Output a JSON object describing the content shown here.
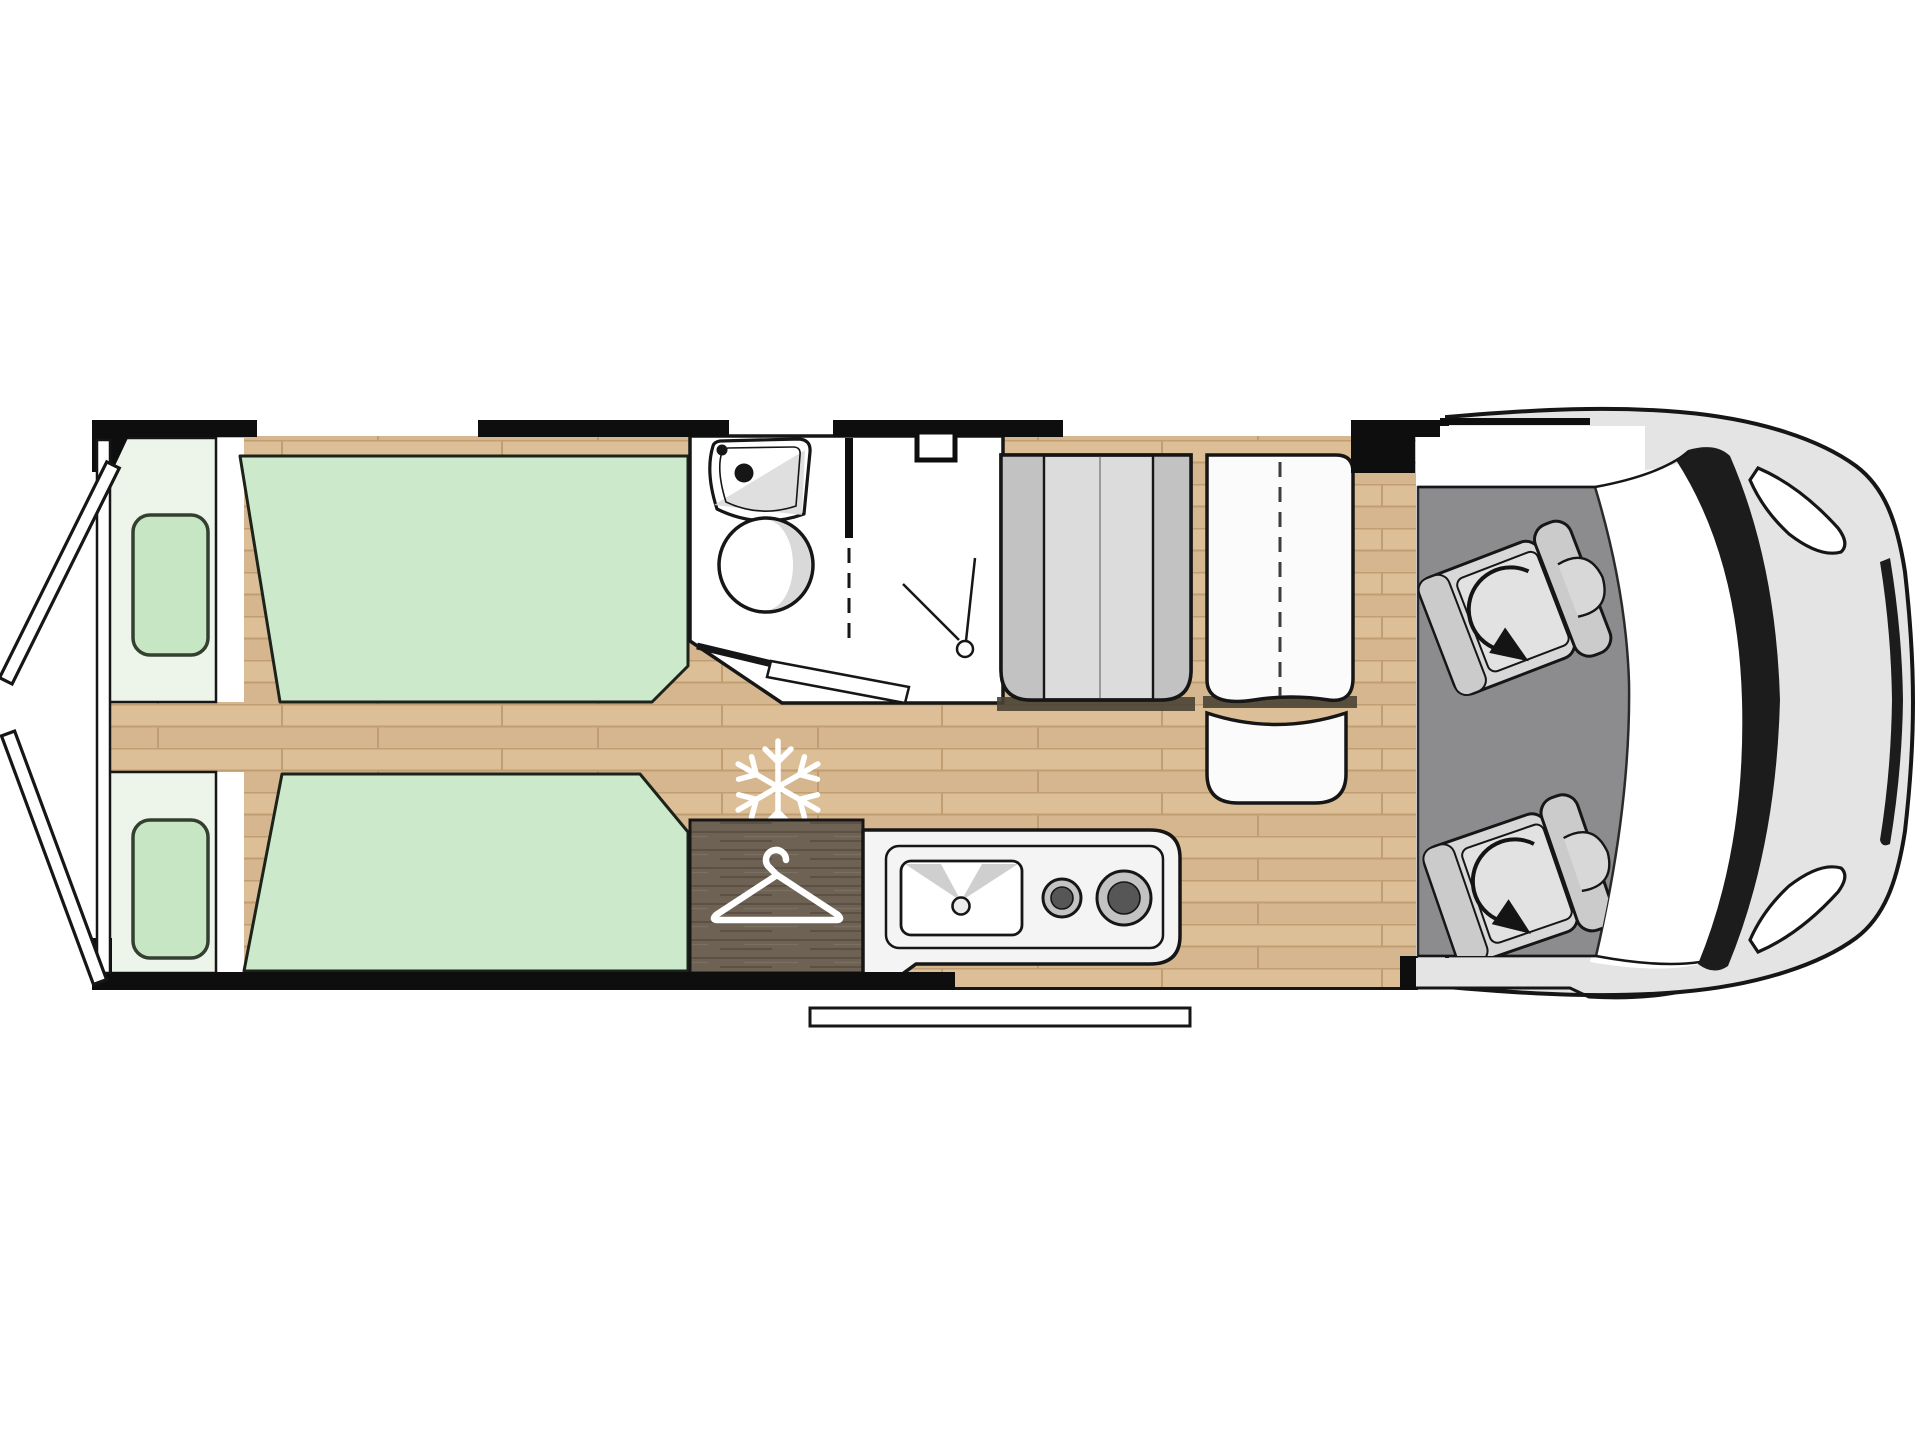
{
  "title": "motorhome-floorplan",
  "colors": {
    "bg": "#ffffff",
    "outline": "#161616",
    "wall": "#0e0e0e",
    "wood_base": "#d6b68e",
    "wood_line": "#c19e72",
    "wood_light": "#e6cda6",
    "mattress": "#cde9cb",
    "mattress_edge": "#1b231b",
    "pillow": "#c7e6c3",
    "pillow_edge": "#33402f",
    "headboard": "#edf5ea",
    "bath_floor": "#ffffff",
    "fixture_shade": "#d9d9d9",
    "wardrobe": "#6e6255",
    "wardrobe_grain": "#564b3f",
    "icon_white": "#ffffff",
    "kitchen_body": "#f4f4f4",
    "burner_ring": "#c3c3c3",
    "burner_core": "#565656",
    "bench_light": "#dcdcdc",
    "bench_dark": "#c2c2c2",
    "table_fill": "#fbfbfb",
    "cab_floor": "#8c8c8f",
    "seat_fill": "#d8d8d8",
    "seat_band": "#cbcbcb",
    "body_gray": "#e4e4e4",
    "pillar_black": "#1c1c1c",
    "glass_white": "#ffffff",
    "shadow": "#4a4234"
  },
  "icons": {
    "snowflake": "snowflake-icon (fridge/freezer position)",
    "hanger": "hanger-icon (wardrobe)",
    "rotation_arrow": "rotation-arrow-icon (swivel cab seat)",
    "sink": "washroom-sink-icon",
    "toilet": "toilet-icon",
    "shower_door": "shower-door-icon",
    "kitchen_sink": "kitchen-sink-icon",
    "hob": "two-burner-hob-icon"
  },
  "zones": [
    {
      "id": "rear-doors",
      "label": "open rear doors"
    },
    {
      "id": "bed-top",
      "label": "single bed with pillow"
    },
    {
      "id": "bed-bottom",
      "label": "single bed with pillow"
    },
    {
      "id": "washroom",
      "label": "washroom with sink, toilet and shower"
    },
    {
      "id": "fridge",
      "label": "fridge position (snowflake)"
    },
    {
      "id": "wardrobe",
      "label": "wardrobe (hanger)"
    },
    {
      "id": "kitchen",
      "label": "kitchen with sink and two burners"
    },
    {
      "id": "dinette",
      "label": "bench, folding table and side seat"
    },
    {
      "id": "entry-step",
      "label": "entrance step"
    },
    {
      "id": "cab",
      "label": "driver cab with two swivel seats"
    },
    {
      "id": "vehicle-front",
      "label": "vehicle nose with windshield and mirrors"
    }
  ]
}
